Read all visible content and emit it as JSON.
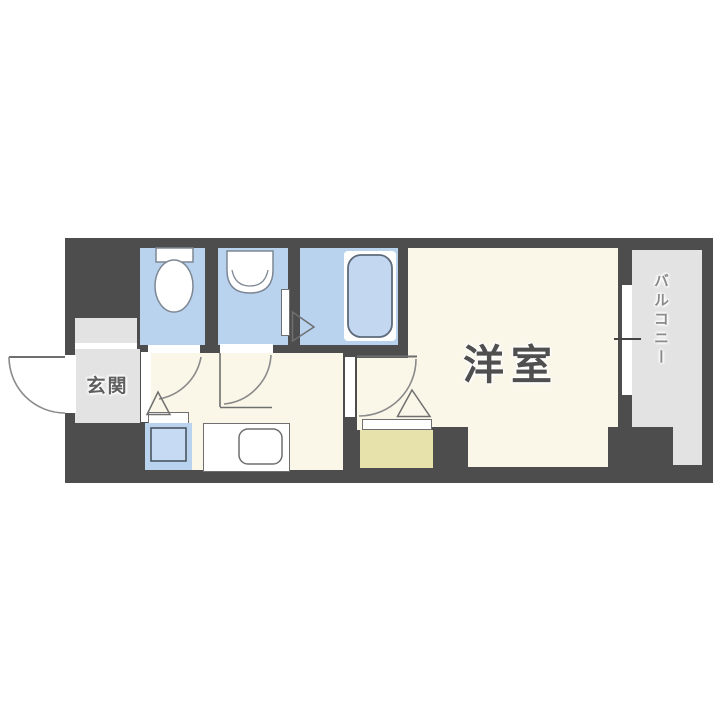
{
  "labels": {
    "entrance": "玄関",
    "western_room": "洋室",
    "balcony": "バルコニー"
  },
  "colors": {
    "wall": "#4d4d4d",
    "floor_cream": "#faf6e8",
    "wet_area_blue": "#b9d3ef",
    "fixture_light_blue": "#c6dbf3",
    "tub_blue": "#c3d7f1",
    "area_gray": "#e3e3e3",
    "closet_yellow": "#e7e1ab",
    "outline": "#6f6f6f",
    "arc": "#8a8a8a",
    "fixture_stroke": "#7d8794",
    "label_text": "#5f5f5f",
    "room_label_text": "#4f4f4f",
    "balcony_text": "#8a8a8a"
  },
  "icons": {
    "toilet": "toilet-icon",
    "washbasin": "washbasin-icon",
    "bathtub": "bathtub-icon",
    "kitchen_sink": "kitchen-sink-icon",
    "washer_pan": "washer-pan-icon",
    "entrance_door": "door-swing-icon",
    "window": "window-icon"
  }
}
